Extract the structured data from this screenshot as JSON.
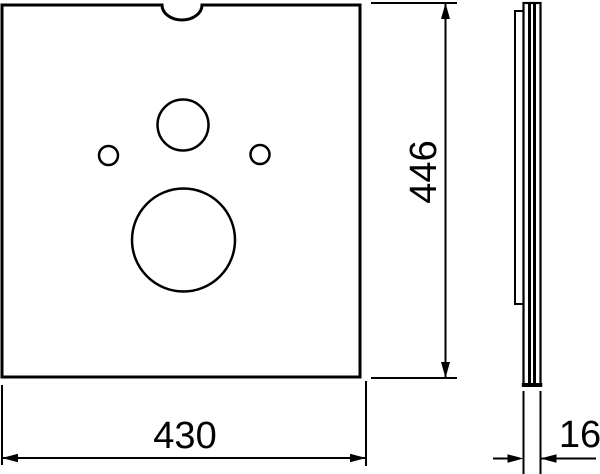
{
  "canvas": {
    "width": 600,
    "height": 474,
    "background_color": "#ffffff",
    "line_color": "#000000"
  },
  "drawing": {
    "kind": "two-view technical drawing of a flat panel",
    "front_view": {
      "outline": "square panel with semicircular notch at top center",
      "holes": [
        "medium-hole-top-center",
        "small-hole-left",
        "small-hole-right",
        "large-hole-bottom-center"
      ]
    },
    "side_view": {
      "layers": [
        "thin-film-strip",
        "panel-body-with-two-core-stripes"
      ]
    },
    "dimensions": {
      "width": "430",
      "height": "446",
      "thickness": "16"
    }
  }
}
